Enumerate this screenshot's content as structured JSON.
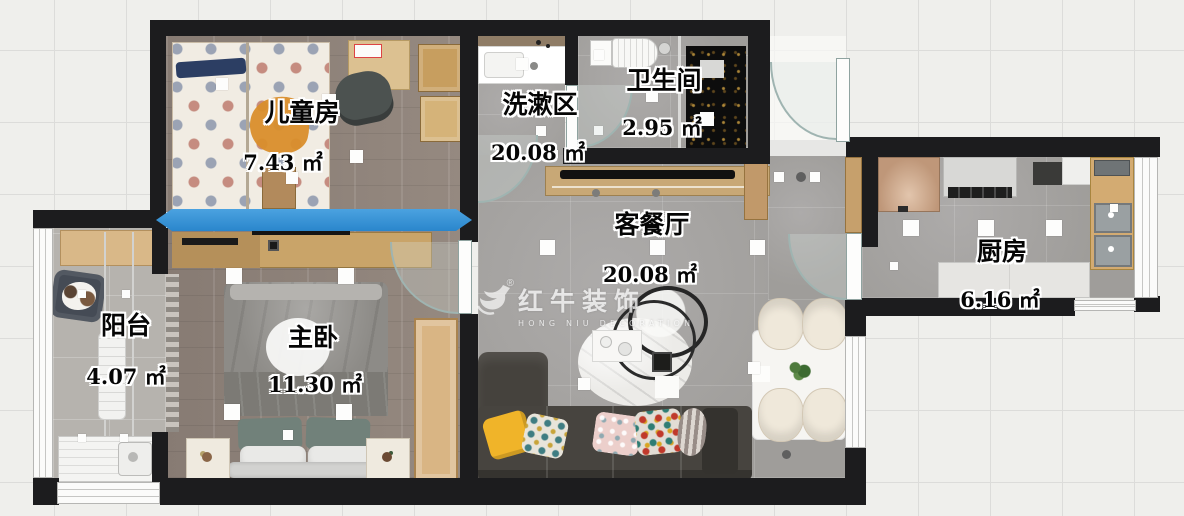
{
  "plan": {
    "rooms": [
      {
        "id": "children",
        "name": "儿童房",
        "area": "7.43 ㎡"
      },
      {
        "id": "wash",
        "name": "洗漱区",
        "area": "20.08 ㎡"
      },
      {
        "id": "bath",
        "name": "卫生间",
        "area": "2.95 ㎡"
      },
      {
        "id": "living",
        "name": "客餐厅",
        "area": "20.08 ㎡"
      },
      {
        "id": "kitchen",
        "name": "厨房",
        "area": "6.16 ㎡"
      },
      {
        "id": "balcony",
        "name": "阳台",
        "area": "4.07 ㎡"
      },
      {
        "id": "master",
        "name": "主卧",
        "area": "11.30 ㎡"
      }
    ],
    "watermark": {
      "brand": "红牛装饰",
      "subtitle": "HONG NIU DECORATION",
      "registered": "®"
    },
    "colors": {
      "wall": "#1c1c1e",
      "highlight_arrow": "#2e8ed6",
      "wood_floor": "#8b7f77",
      "tile_floor": "#a7a5a2",
      "shower_tile": "#0d0d0d",
      "accent_pillow": "#f0b429"
    }
  }
}
